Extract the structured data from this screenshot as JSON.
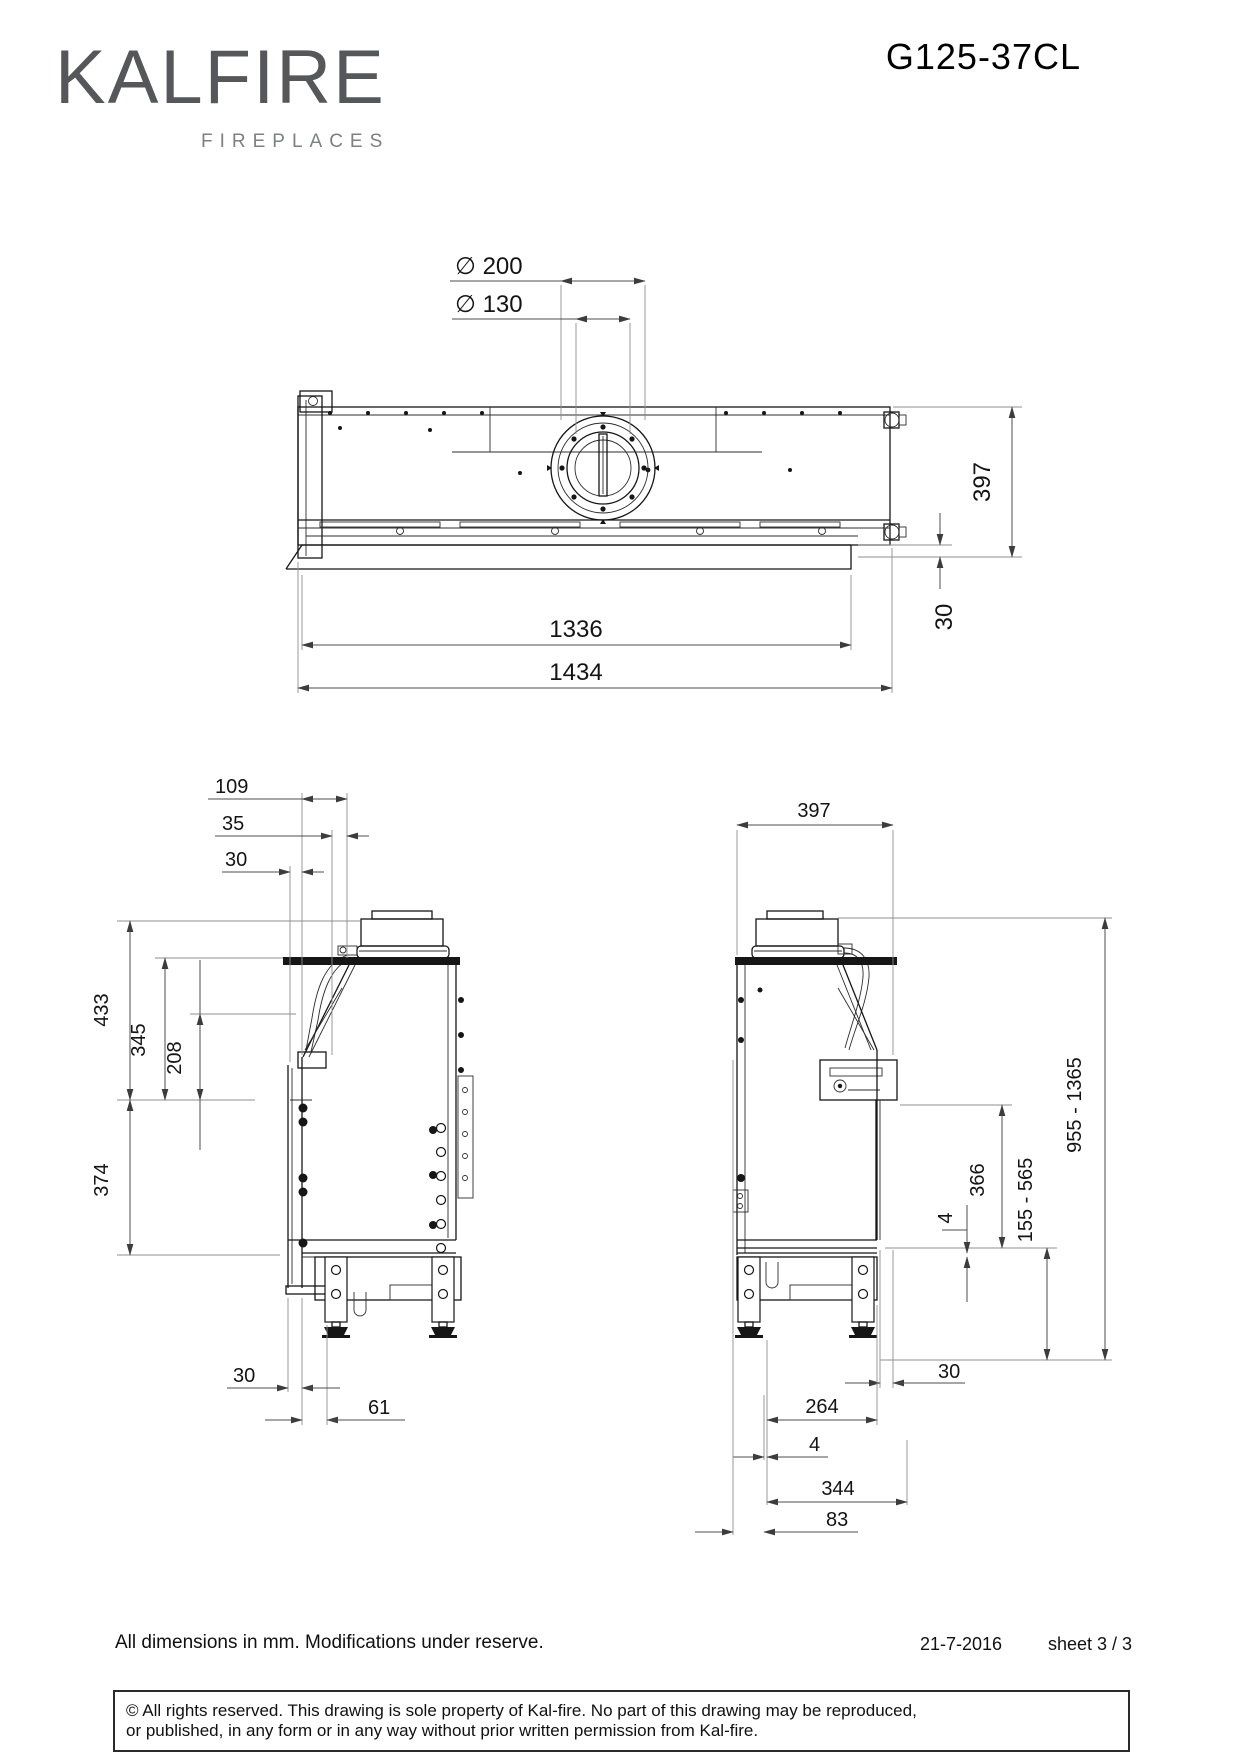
{
  "header": {
    "brand": "KALFIRE",
    "brand_subtitle": "FIREPLACES",
    "model": "G125-37CL"
  },
  "top_view": {
    "dims": {
      "flue_outer": "∅ 200",
      "flue_inner": "∅ 130",
      "depth": "397",
      "front_lip": "30",
      "width_hearth": "1336",
      "width_total": "1434"
    }
  },
  "left_view": {
    "dims": {
      "offset_109": "109",
      "offset_35": "35",
      "offset_30": "30",
      "height_433": "433",
      "height_345": "345",
      "height_208": "208",
      "glass_374": "374",
      "bottom_30": "30",
      "bottom_61": "61"
    }
  },
  "right_view": {
    "dims": {
      "depth_397": "397",
      "total_height": "955 - 1365",
      "opening_366": "366",
      "burner_height": "155 - 565",
      "bottom_30": "30",
      "bottom_264": "264",
      "bottom_4": "4",
      "gap_4": "4",
      "bottom_344": "344",
      "bottom_83": "83"
    }
  },
  "footer": {
    "note": "All dimensions in mm. Modifications under reserve.",
    "date": "21-7-2016",
    "sheet": "sheet 3 / 3",
    "copyright_line1": "© All rights reserved. This drawing is sole property of Kal-fire. No part of this drawing may be reproduced,",
    "copyright_line2": "or published, in any form or in any way without prior written permission from Kal-fire."
  }
}
